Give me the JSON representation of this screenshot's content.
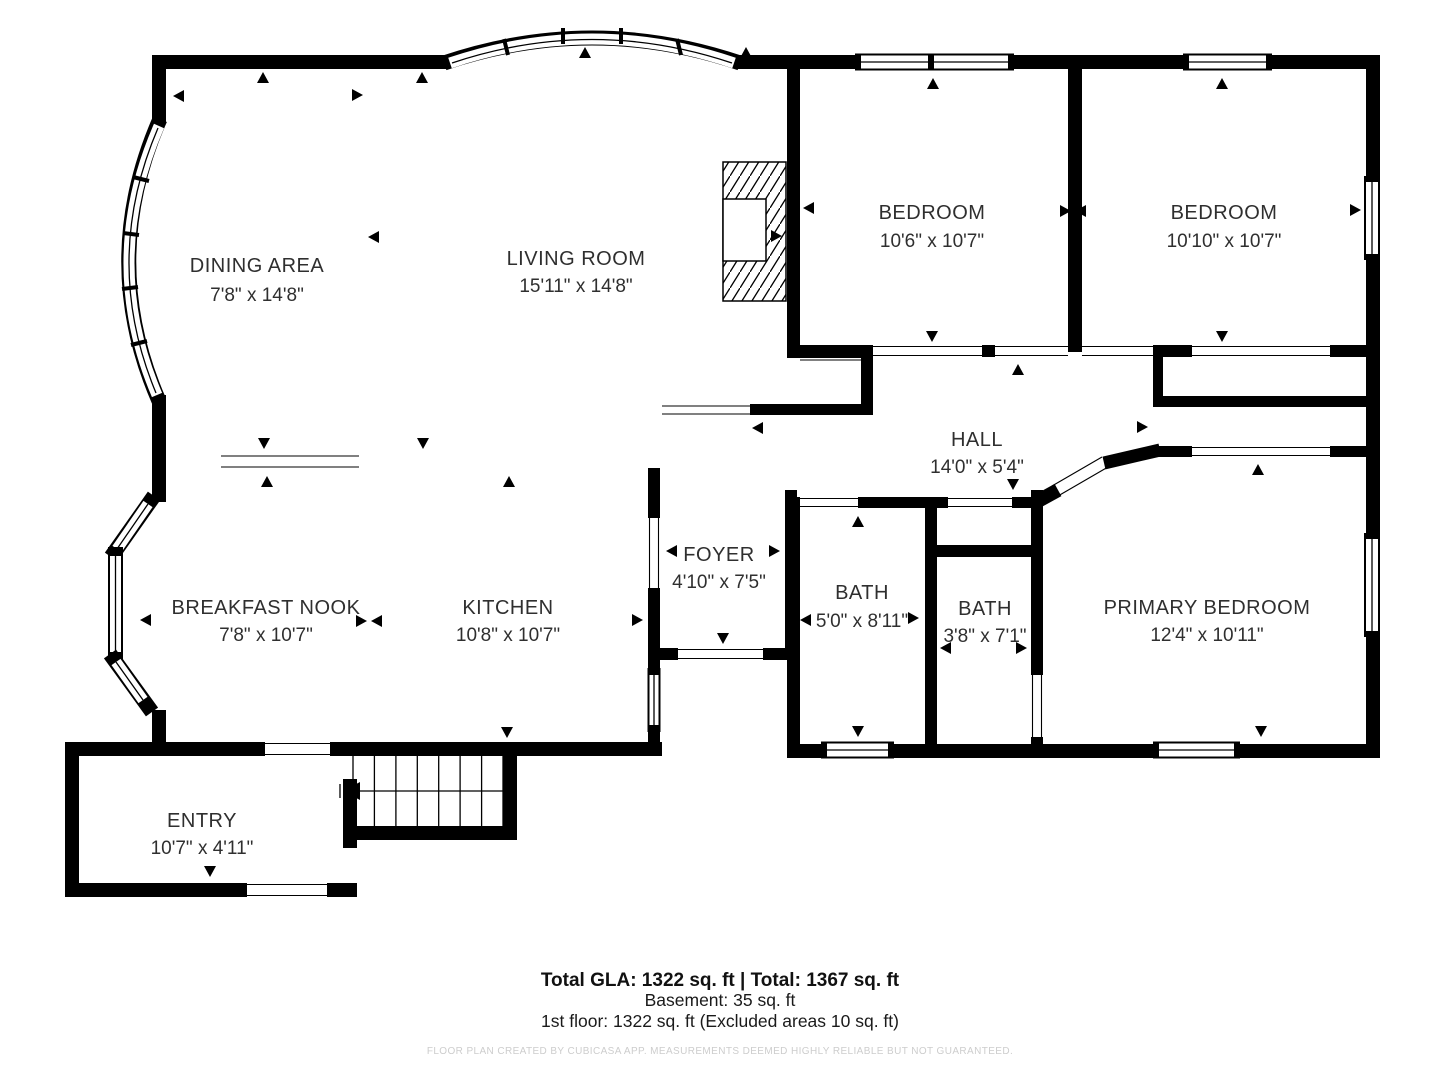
{
  "floor_plan": {
    "rooms": [
      {
        "name": "DINING AREA",
        "dims": "7'8\" x 14'8\""
      },
      {
        "name": "LIVING ROOM",
        "dims": "15'11\" x 14'8\""
      },
      {
        "name": "BEDROOM",
        "dims": "10'6\" x 10'7\""
      },
      {
        "name": "BEDROOM",
        "dims": "10'10\" x 10'7\""
      },
      {
        "name": "HALL",
        "dims": "14'0\" x 5'4\""
      },
      {
        "name": "BREAKFAST NOOK",
        "dims": "7'8\" x 10'7\""
      },
      {
        "name": "KITCHEN",
        "dims": "10'8\" x 10'7\""
      },
      {
        "name": "FOYER",
        "dims": "4'10\" x 7'5\""
      },
      {
        "name": "BATH",
        "dims": "5'0\" x 8'11\""
      },
      {
        "name": "BATH",
        "dims": "3'8\" x 7'1\""
      },
      {
        "name": "PRIMARY BEDROOM",
        "dims": "12'4\" x 10'11\""
      },
      {
        "name": "ENTRY",
        "dims": "10'7\" x 4'11\""
      }
    ],
    "summary": {
      "line1": "Total GLA: 1322 sq. ft | Total: 1367 sq. ft",
      "line2": "Basement: 35 sq. ft",
      "line3": "1st floor: 1322 sq. ft (Excluded areas 10 sq. ft)"
    },
    "disclaimer": "FLOOR PLAN CREATED BY CUBICASA APP. MEASUREMENTS DEEMED HIGHLY RELIABLE BUT NOT GUARANTEED.",
    "colors": {
      "wall": "#000000",
      "text": "#2f2f2f",
      "disclaimer": "#cdcdcd"
    }
  }
}
